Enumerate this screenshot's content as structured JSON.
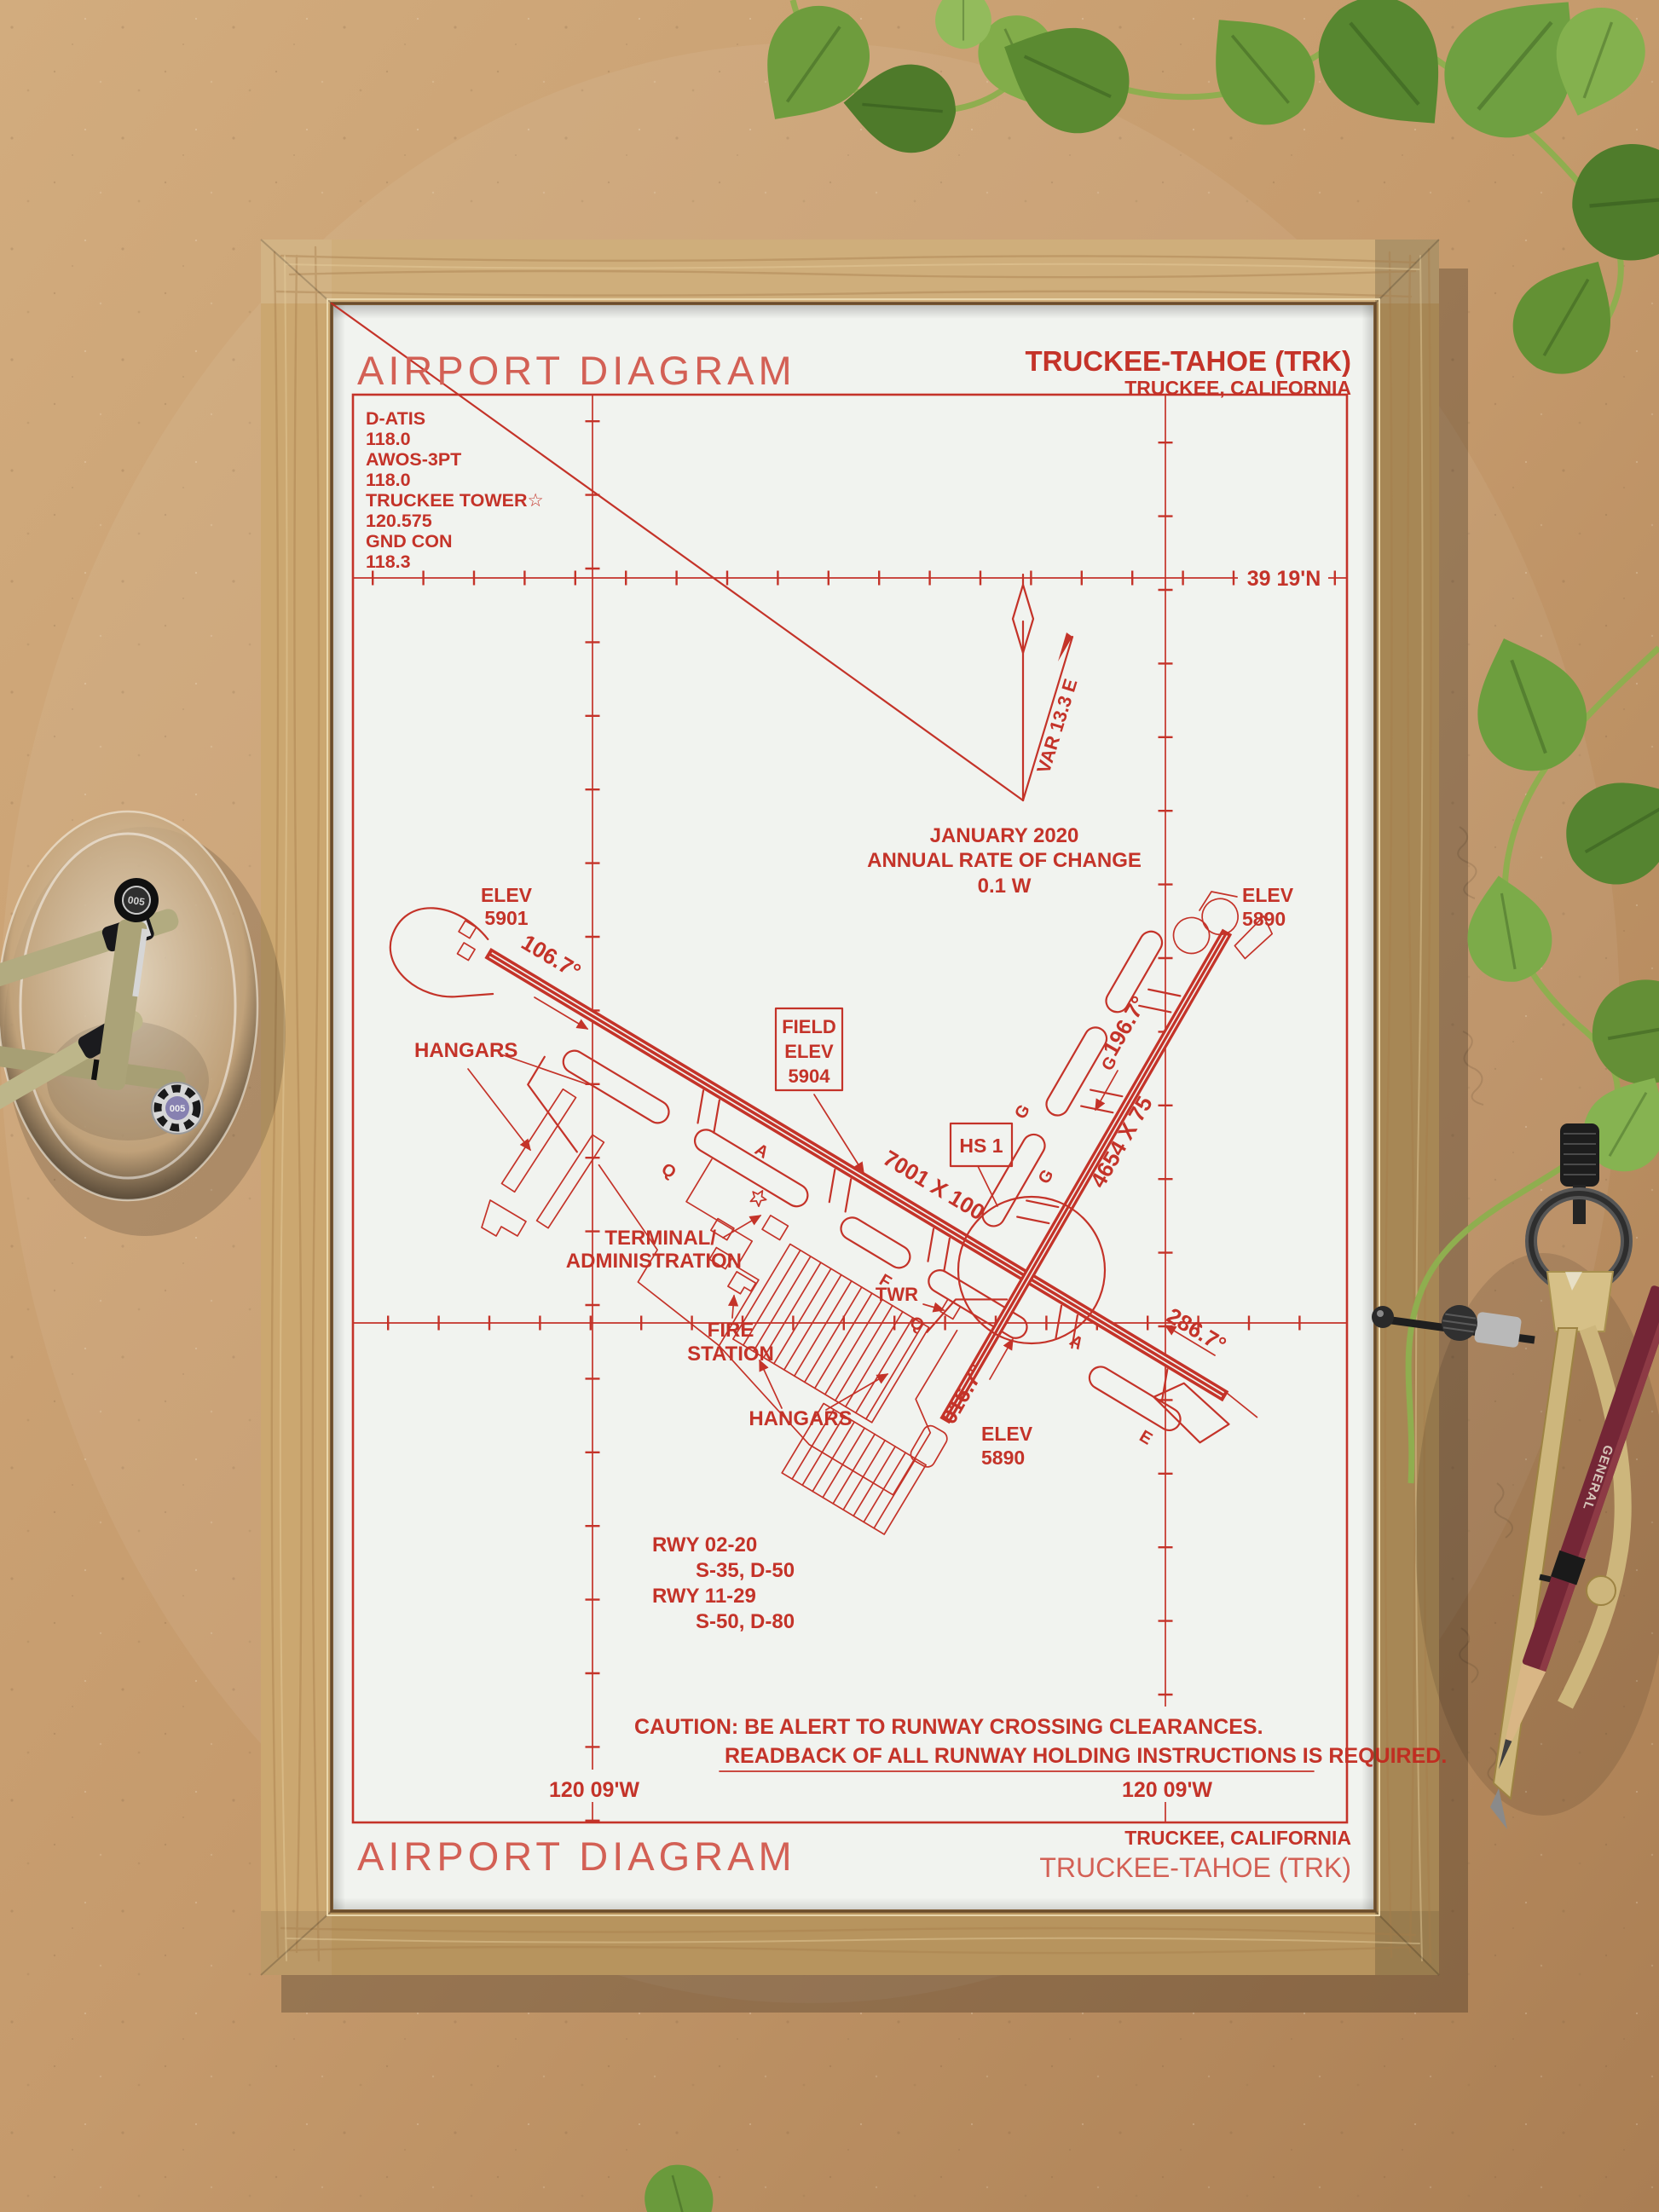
{
  "poster": {
    "header": {
      "title": "AIRPORT DIAGRAM",
      "name": "TRUCKEE-TAHOE (TRK)",
      "city": "TRUCKEE, CALIFORNIA"
    },
    "footer": {
      "title": "AIRPORT DIAGRAM",
      "city": "TRUCKEE, CALIFORNIA",
      "name": "TRUCKEE-TAHOE (TRK)"
    },
    "comm": {
      "l0": "D-ATIS",
      "l1": "118.0",
      "l2": "AWOS-3PT",
      "l3": "118.0",
      "l4": "TRUCKEE TOWER☆",
      "l5": "120.575",
      "l6": "GND CON",
      "l7": "118.3"
    },
    "grid": {
      "lat": "39 19'N",
      "lon_left": "120 09'W",
      "lon_right": "120 09'W"
    },
    "variation": {
      "var": "VAR 13.3 E",
      "date": "JANUARY 2020",
      "rate": "ANNUAL RATE OF CHANGE",
      "rate_value": "0.1  W"
    },
    "field_elev": {
      "l0": "FIELD",
      "l1": "ELEV",
      "l2": "5904"
    },
    "hotspot": {
      "label": "HS 1"
    },
    "rwy1129": {
      "dim": "7001 X 100",
      "hdg11": "106.7°",
      "hdg29": "286.7°",
      "elev11_l0": "ELEV",
      "elev11_l1": "5901"
    },
    "rwy0220": {
      "dim": "4654 X 75",
      "hdg02": "016.7°",
      "hdg20": "196.7°",
      "elev20_l0": "ELEV",
      "elev20_l1": "5890",
      "elev02_l0": "ELEV",
      "elev02_l1": "5890"
    },
    "labels": {
      "hangars_left": "HANGARS",
      "hangars_bottom": "HANGARS",
      "terminal_l0": "TERMINAL/",
      "terminal_l1": "ADMINISTRATION",
      "fire_l0": "FIRE",
      "fire_l1": "STATION",
      "twr": "TWR"
    },
    "taxiways": {
      "a": "A",
      "q": "Q",
      "g": "G",
      "f": "F",
      "e": "E"
    },
    "rwy_info": {
      "l0": "RWY 02-20",
      "l1": "S-35, D-50",
      "l2": "RWY 11-29",
      "l3": "S-50, D-80"
    },
    "caution": {
      "l0": "CAUTION: BE ALERT TO RUNWAY CROSSING CLEARANCES.",
      "l1": "READBACK OF ALL RUNWAY HOLDING INSTRUCTIONS IS REQUIRED."
    }
  },
  "decor": {
    "pen_cap": "005",
    "pencil_brand": "GENERAL"
  },
  "colors": {
    "ink_red": "#c2291f",
    "paper": "#f1f3ef",
    "frame_wood": "#c7a166",
    "cardboard": "#c49a6c",
    "leaf_green": "#6a9a3c",
    "brass": "#cdb67c"
  }
}
